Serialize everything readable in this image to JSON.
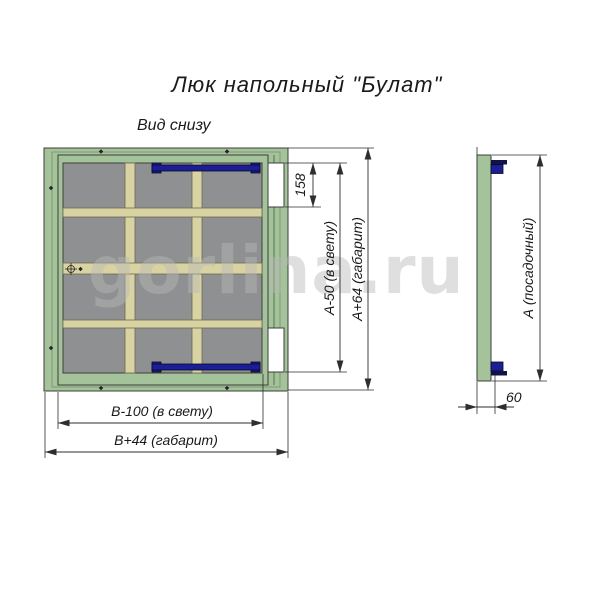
{
  "title": "Люк напольный \"Булат\"",
  "view_label": "Вид снизу",
  "watermark": "gorlina.ru",
  "dimensions": {
    "main_view": {
      "hinge_length": "158",
      "height_clear": "А-50 (в свету)",
      "height_overall": "А+64 (габарит)",
      "width_clear": "В-100 (в свету)",
      "width_overall": "В+44 (габарит)"
    },
    "side_view": {
      "seat_height": "А (посадочный)",
      "depth": "60"
    }
  },
  "colors": {
    "frame_green": "#a4c39a",
    "frame_green_dark": "#7f9a74",
    "panel_gray": "#8f9091",
    "rib_tan": "#d9d3a3",
    "handle_navy": "#1b1e96",
    "hinge_cutout_white": "#ffffff",
    "line_color": "#2e2e2e",
    "watermark_gray": "#b8b8b8"
  }
}
